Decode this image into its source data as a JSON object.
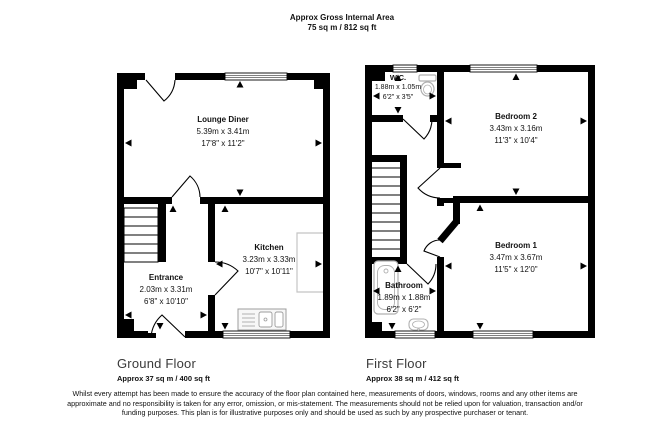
{
  "title": {
    "line1": "Approx Gross Internal Area",
    "line2": "75 sq m / 812 sq ft"
  },
  "floors": [
    {
      "name": "Ground Floor",
      "area": "Approx 37 sq m / 400 sq ft",
      "rooms": [
        {
          "name": "Lounge Diner",
          "metric": "5.39m x 3.41m",
          "imperial": "17'8\" x 11'2\""
        },
        {
          "name": "Entrance",
          "metric": "2.03m x 3.31m",
          "imperial": "6'8\" x 10'10\""
        },
        {
          "name": "Kitchen",
          "metric": "3.23m x 3.33m",
          "imperial": "10'7\" x 10'11\""
        }
      ]
    },
    {
      "name": "First Floor",
      "area": "Approx 38 sq m / 412 sq ft",
      "rooms": [
        {
          "name": "W.C.",
          "metric": "1.88m x 1.05m",
          "imperial": "6'2\" x 3'5\""
        },
        {
          "name": "Bedroom 2",
          "metric": "3.43m x 3.16m",
          "imperial": "11'3\" x 10'4\""
        },
        {
          "name": "Bedroom 1",
          "metric": "3.47m x 3.67m",
          "imperial": "11'5\" x 12'0\""
        },
        {
          "name": "Bathroom",
          "metric": "1.89m x 1.88m",
          "imperial": "6'2\" x 6'2\""
        }
      ]
    }
  ],
  "colors": {
    "wall": "#000000",
    "fixture_gray": "#b0b0b0",
    "counter_gray": "#c4c4c4"
  },
  "disclaimer": "Whilst every attempt has been made to ensure the accuracy of the floor plan contained here, measurements of doors, windows, rooms and any other items are approximate and no responsibility is taken for any error, omission, or mis-statement. The measurements should not be relied upon for valuation, transaction and/or funding purposes. This plan is for illustrative purposes only and should be used as such by any prospective purchaser or tenant."
}
